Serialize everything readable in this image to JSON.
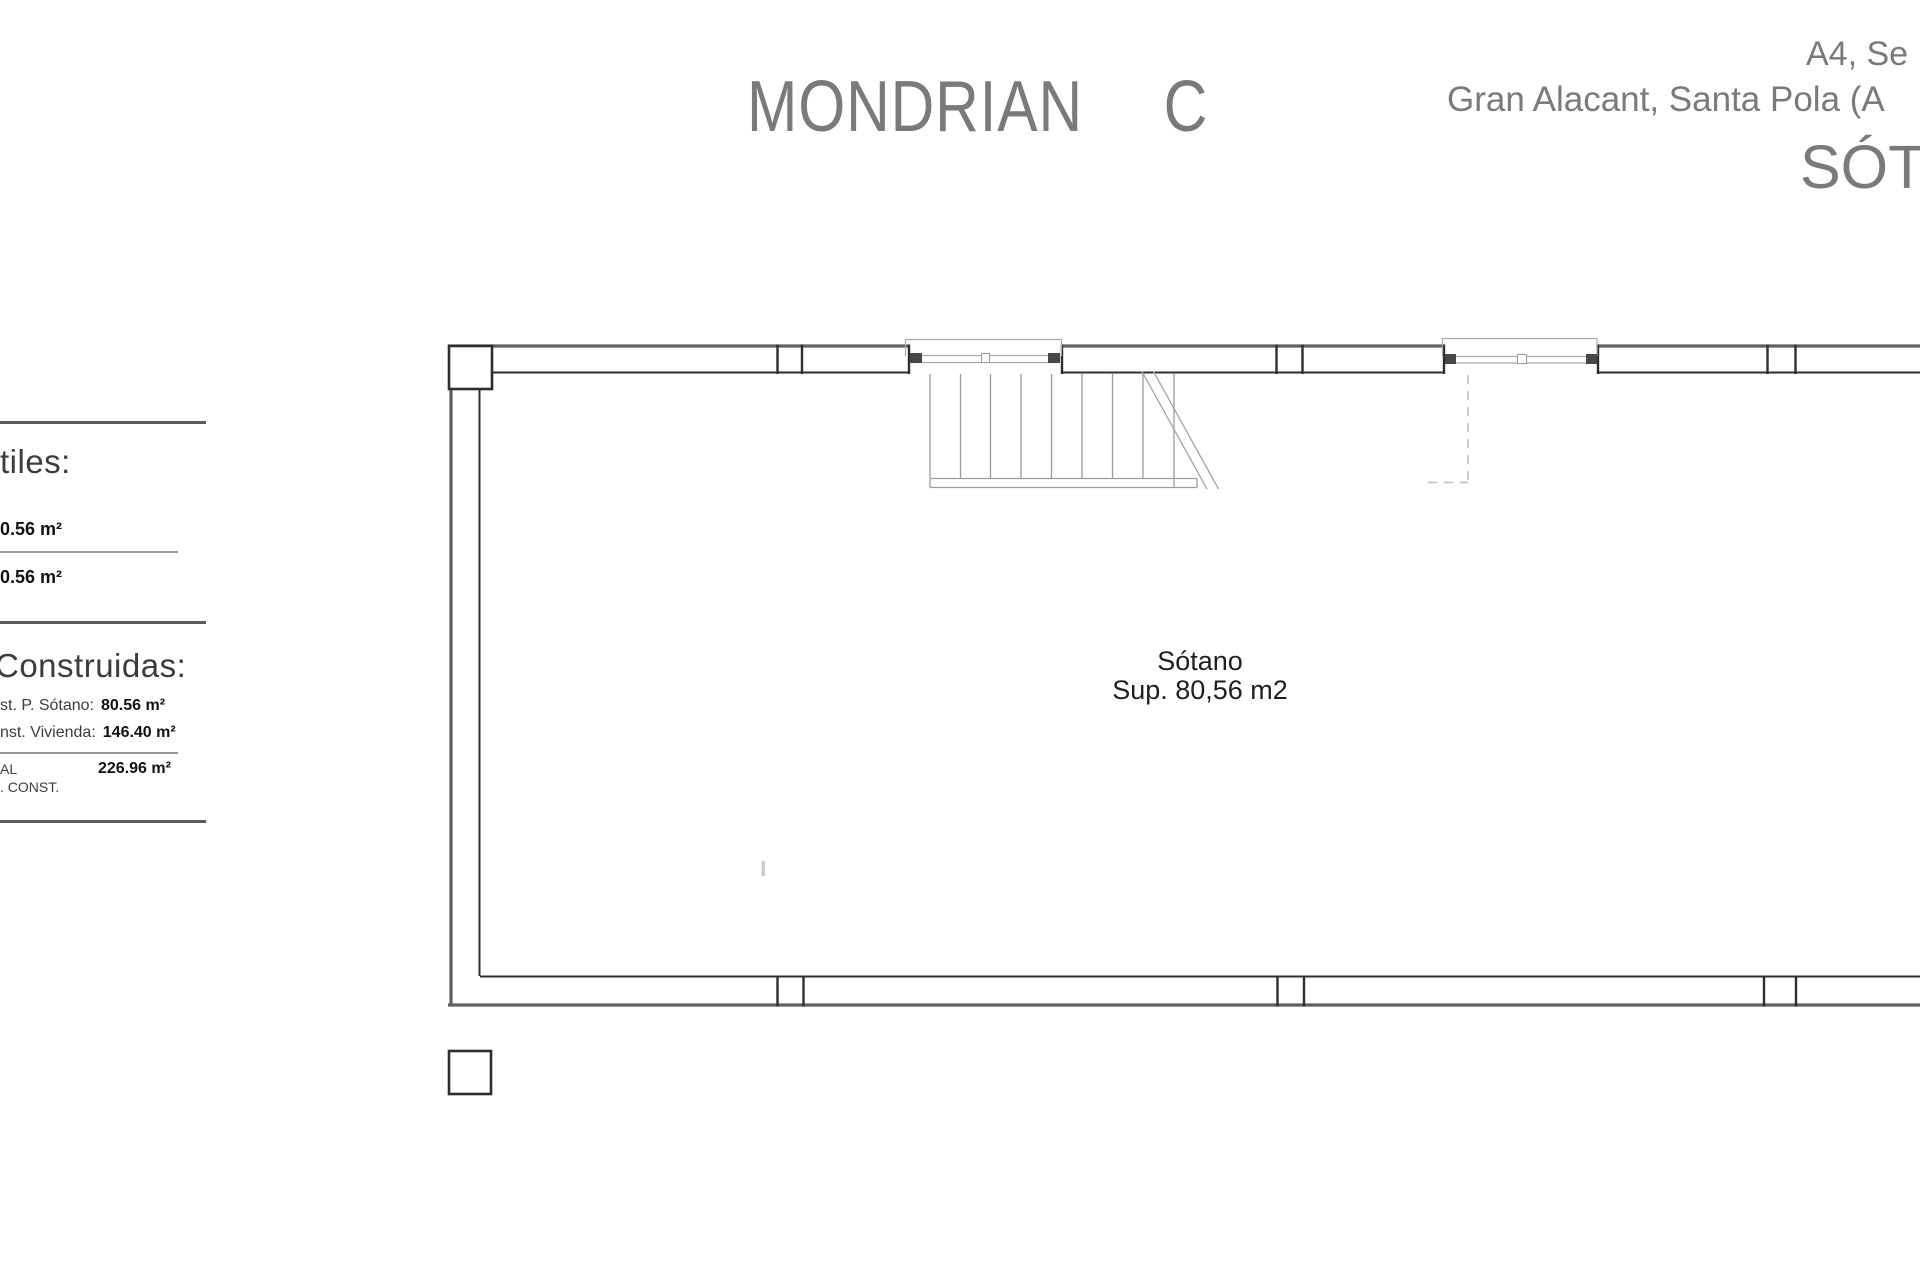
{
  "title": {
    "main": "MONDRIAN",
    "variant": "C"
  },
  "header_right": {
    "line1": "A4, Se",
    "line2": "Gran Alacant, Santa Pola (A",
    "line3": "SÓT"
  },
  "sidebar": {
    "utiles": {
      "heading": "tiles:",
      "row1_value": "0.56 m²",
      "row2_value": "0.56 m²"
    },
    "construidas": {
      "heading": "Construidas:",
      "rows": [
        {
          "label": "st. P. Sótano:",
          "value": "80.56 m²"
        },
        {
          "label": "nst. Vivienda:",
          "value": "146.40 m²"
        }
      ],
      "total": {
        "label_line1": "AL",
        "label_line2": ". CONST.",
        "value": "226.96 m²"
      }
    }
  },
  "plan": {
    "room_name": "Sótano",
    "room_area": "Sup. 80,56 m2"
  },
  "colors": {
    "header_gray": "#7a7a7a",
    "sidebar_text": "#3c3c3c",
    "value_black": "#111111",
    "wall_outer_gray": "#5f5f5f",
    "wall_dark": "#2e2e2e",
    "thin_line_gray": "#9c9c9c",
    "dashed_gray": "#bcbcbc"
  }
}
